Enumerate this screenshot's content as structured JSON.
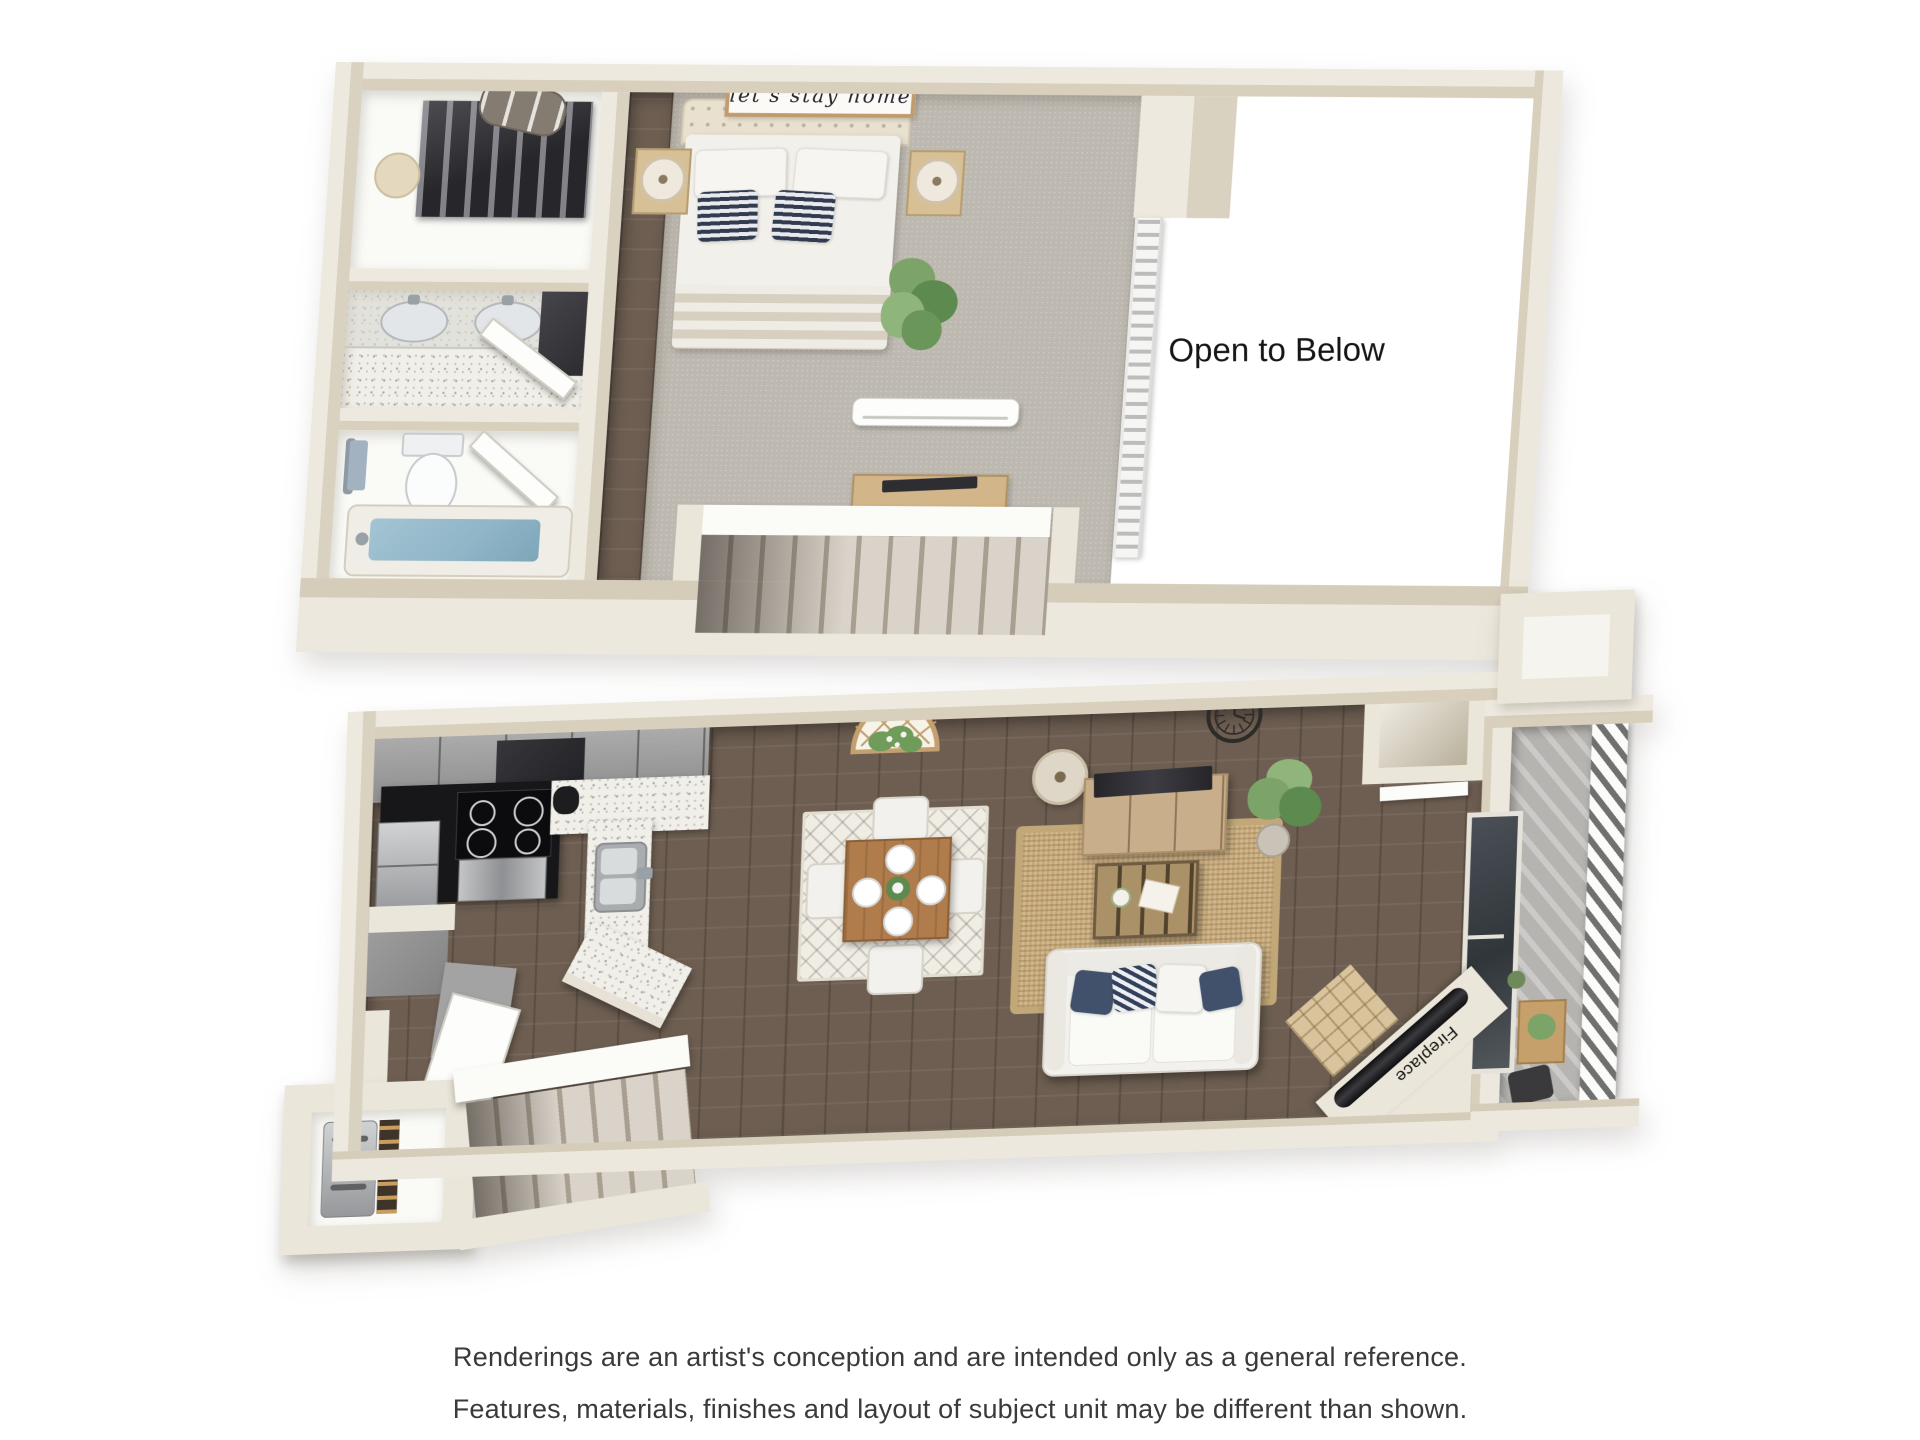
{
  "texts": {
    "open_to_below": "Open to Below",
    "bed_sign": "let's stay home",
    "fireplace": "Fireplace"
  },
  "disclaimer": {
    "line1": "Renderings are an artist's conception and are intended only as a general reference.",
    "line2": "Features, materials, finishes and layout of subject unit may be different than shown."
  },
  "palette": {
    "wall": "#ebe6da",
    "wall_face": "#d8d0bd",
    "carpet": "#bdb9b1",
    "wood": "#6d5e51",
    "terrazzo": "#f0efea",
    "cabinet_gray": "#9c9c9c",
    "appliance_black": "#141416",
    "water": "#8fb5c7",
    "jute": "#d1b78b",
    "rug_light": "#f0ede4",
    "sofa": "#f2f1ed",
    "green": "#7ca368",
    "green_dark": "#5d8a4f",
    "concrete": "#b6b4b0",
    "tan_wood": "#d2b689",
    "navy": "#41506b",
    "text_dark": "#151515",
    "disclaimer_text": "#3a3a3a"
  }
}
